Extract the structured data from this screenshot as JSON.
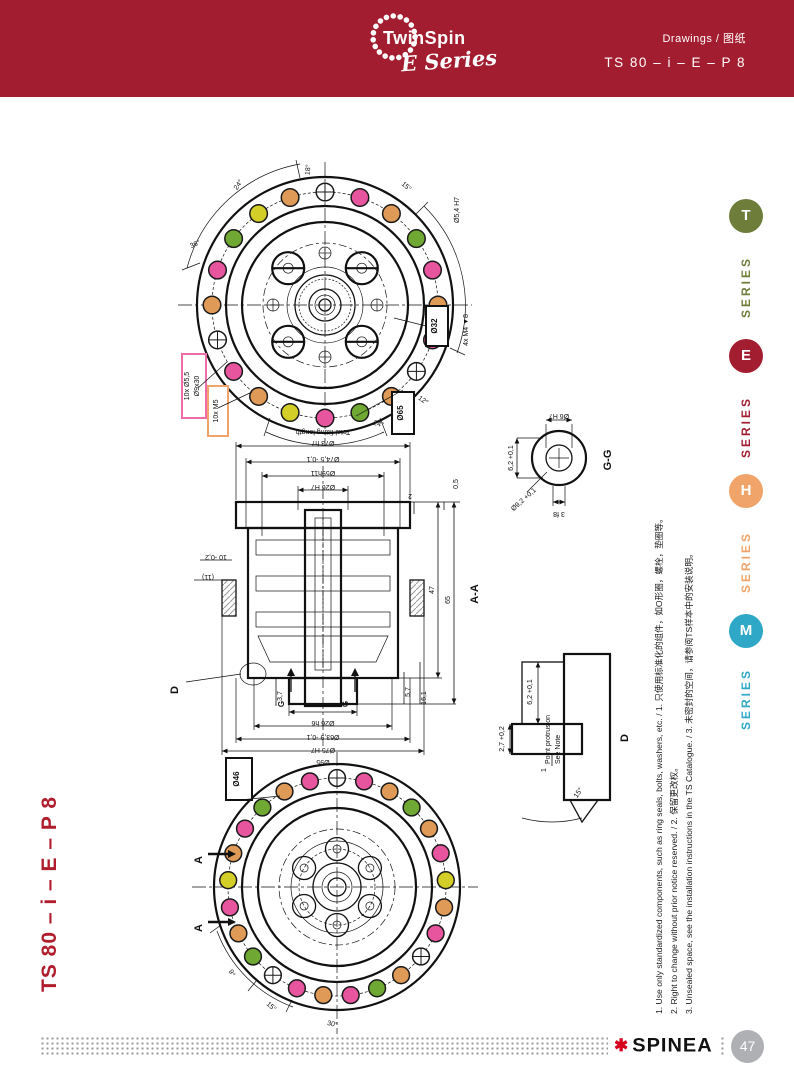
{
  "palette": {
    "header_red": "#A21D2F",
    "series_t_olive": "#6E7D3A",
    "series_e_red": "#A21D2F",
    "series_h_orange": "#F0A469",
    "series_m_teal": "#2FA8C7",
    "dot_magenta": "#E8559F",
    "dot_orange": "#E09A57",
    "dot_green": "#6FA832",
    "dot_yellow": "#D4CE29",
    "highlight_pink": "#F06CA8",
    "highlight_orange": "#F0A469",
    "spinea_red": "#D6001C"
  },
  "header": {
    "brand": "TwinSpin",
    "series_script": "E Series",
    "doc_type": "Drawings / 图纸",
    "doc_code": "TS 80 – i – E – P 8"
  },
  "sidebar": {
    "items": [
      {
        "letter": "T",
        "label": "SERIES",
        "color": "#6E7D3A"
      },
      {
        "letter": "E",
        "label": "SERIES",
        "color": "#A21D2F"
      },
      {
        "letter": "H",
        "label": "SERIES",
        "color": "#F0A469"
      },
      {
        "letter": "M",
        "label": "SERIES",
        "color": "#2FA8C7"
      }
    ]
  },
  "left_title": "TS 80 – i – E – P 8",
  "footnotes": [
    "1. Use only standardized components, such as ring seals, bolts, washers, etc. / 1. 只使用标准化的组件，如O形圈，螺栓，垫圈等。",
    "2. Right to change without prior notice reserved. / 2. 保留更改权。",
    "3. Unsealed space, see the installation instructions in the TS Catalogue. / 3. 未密封的空间，请参阅TS样本中的安装说明。"
  ],
  "footer": {
    "brand": "SPINEA",
    "flower_icon": "✱",
    "page_number": "47"
  },
  "drawings": {
    "front_view": {
      "ring": [
        "x",
        "#E8559F",
        "#E09A57",
        "#6FA832",
        "#E8559F",
        "#E09A57",
        "#E8559F",
        "x",
        "#E09A57",
        "#6FA832",
        "#E8559F",
        "#D4CE29",
        "#E09A57",
        "#E8559F",
        "x",
        "#E09A57",
        "#E8559F",
        "#6FA832",
        "#D4CE29",
        "#E09A57"
      ],
      "labels": {
        "bolt_holes_1": "10x Ø5,5",
        "bolt_holes_2": "Ø9x30",
        "threads": "10x M5",
        "pitch_circle": "Ø65",
        "center_circle": "Ø32",
        "dowel": "Ø5,4 H7",
        "tapped": "4x M4 ▼8"
      },
      "angles": [
        "24°",
        "18°",
        "15°",
        "36°",
        "12°",
        "24°"
      ]
    },
    "section_aa": {
      "view_label": "A-A",
      "top_dims": [
        "Total fitting length",
        "Ø73 h7",
        "Ø74,5 -0,1",
        "Ø59h11",
        "Ø26 H7",
        "2",
        "0,5"
      ],
      "bottom_dims": [
        "Ø26 h6",
        "Ø63,9 -0,1",
        "Ø75 H7",
        "Ø95"
      ],
      "side_dims": [
        "47",
        "65",
        "5,7",
        "16,1",
        "3,7"
      ],
      "left_dims": [
        "10 -0,2",
        "(11)"
      ],
      "marker_g": "G",
      "marker_d": "D",
      "note": [
        "Point protrusion",
        "See Note"
      ]
    },
    "detail_gg": {
      "view_label": "G-G",
      "dims": [
        "Ø6 H7",
        "6,2 +0,1",
        "Ø9,2 +0,1",
        "3 f8"
      ]
    },
    "detail_d": {
      "view_label": "D",
      "dims": [
        "6,2 +0,1",
        "2,7 +0,2",
        "1",
        "15°"
      ]
    },
    "back_view": {
      "ring": [
        "x",
        "#E8559F",
        "#E09A57",
        "#6FA832",
        "#E09A57",
        "#E8559F",
        "#D4CE29",
        "#E09A57",
        "#E8559F",
        "x",
        "#E09A57",
        "#6FA832",
        "#E8559F",
        "#E09A57",
        "#E8559F",
        "x",
        "#6FA832",
        "#E09A57",
        "#E8559F",
        "#D4CE29",
        "#E09A57",
        "#E8559F",
        "#6FA832",
        "#E09A57",
        "#E8559F"
      ],
      "labels": {
        "pitch_circle": "Ø46",
        "section_letter": "A"
      },
      "angles": [
        "30°",
        "15°",
        "9°"
      ]
    }
  }
}
